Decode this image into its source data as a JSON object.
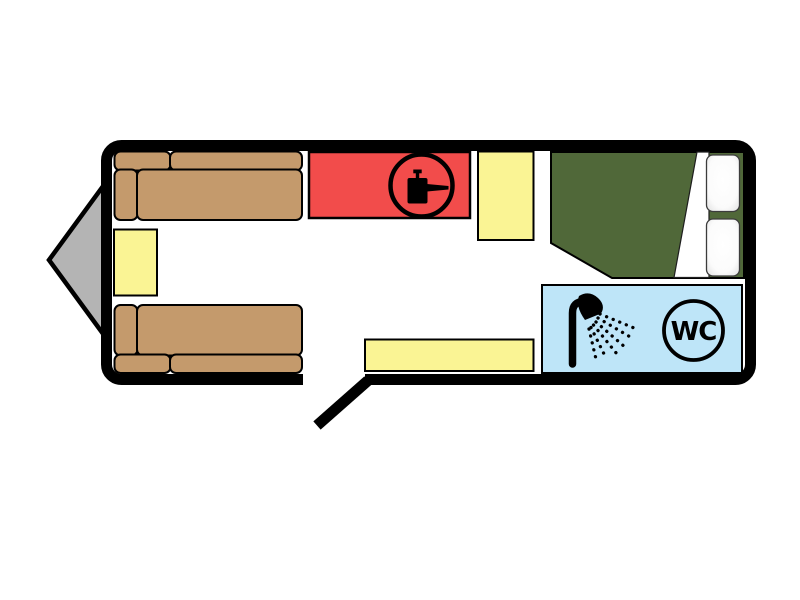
{
  "floorplan": {
    "kind": "caravan-layout-diagram",
    "wc_label": "WC"
  },
  "colors": {
    "page": "#ffffff",
    "wall": "#000000",
    "floor": "#ffffff",
    "hitch": "#b4b4b4",
    "sofa": "#c49a6c",
    "yellow_unit": "#faf494",
    "kitchen": "#f24c4b",
    "bed": "#506839",
    "bathroom": "#bee5f8",
    "pillow_stroke": "#3c3c3c",
    "icon": "#000000"
  },
  "icons": {
    "kitchen_hob": "cooking-pot-icon",
    "shower": "shower-spray-icon",
    "toilet": "wc-circle-icon"
  }
}
